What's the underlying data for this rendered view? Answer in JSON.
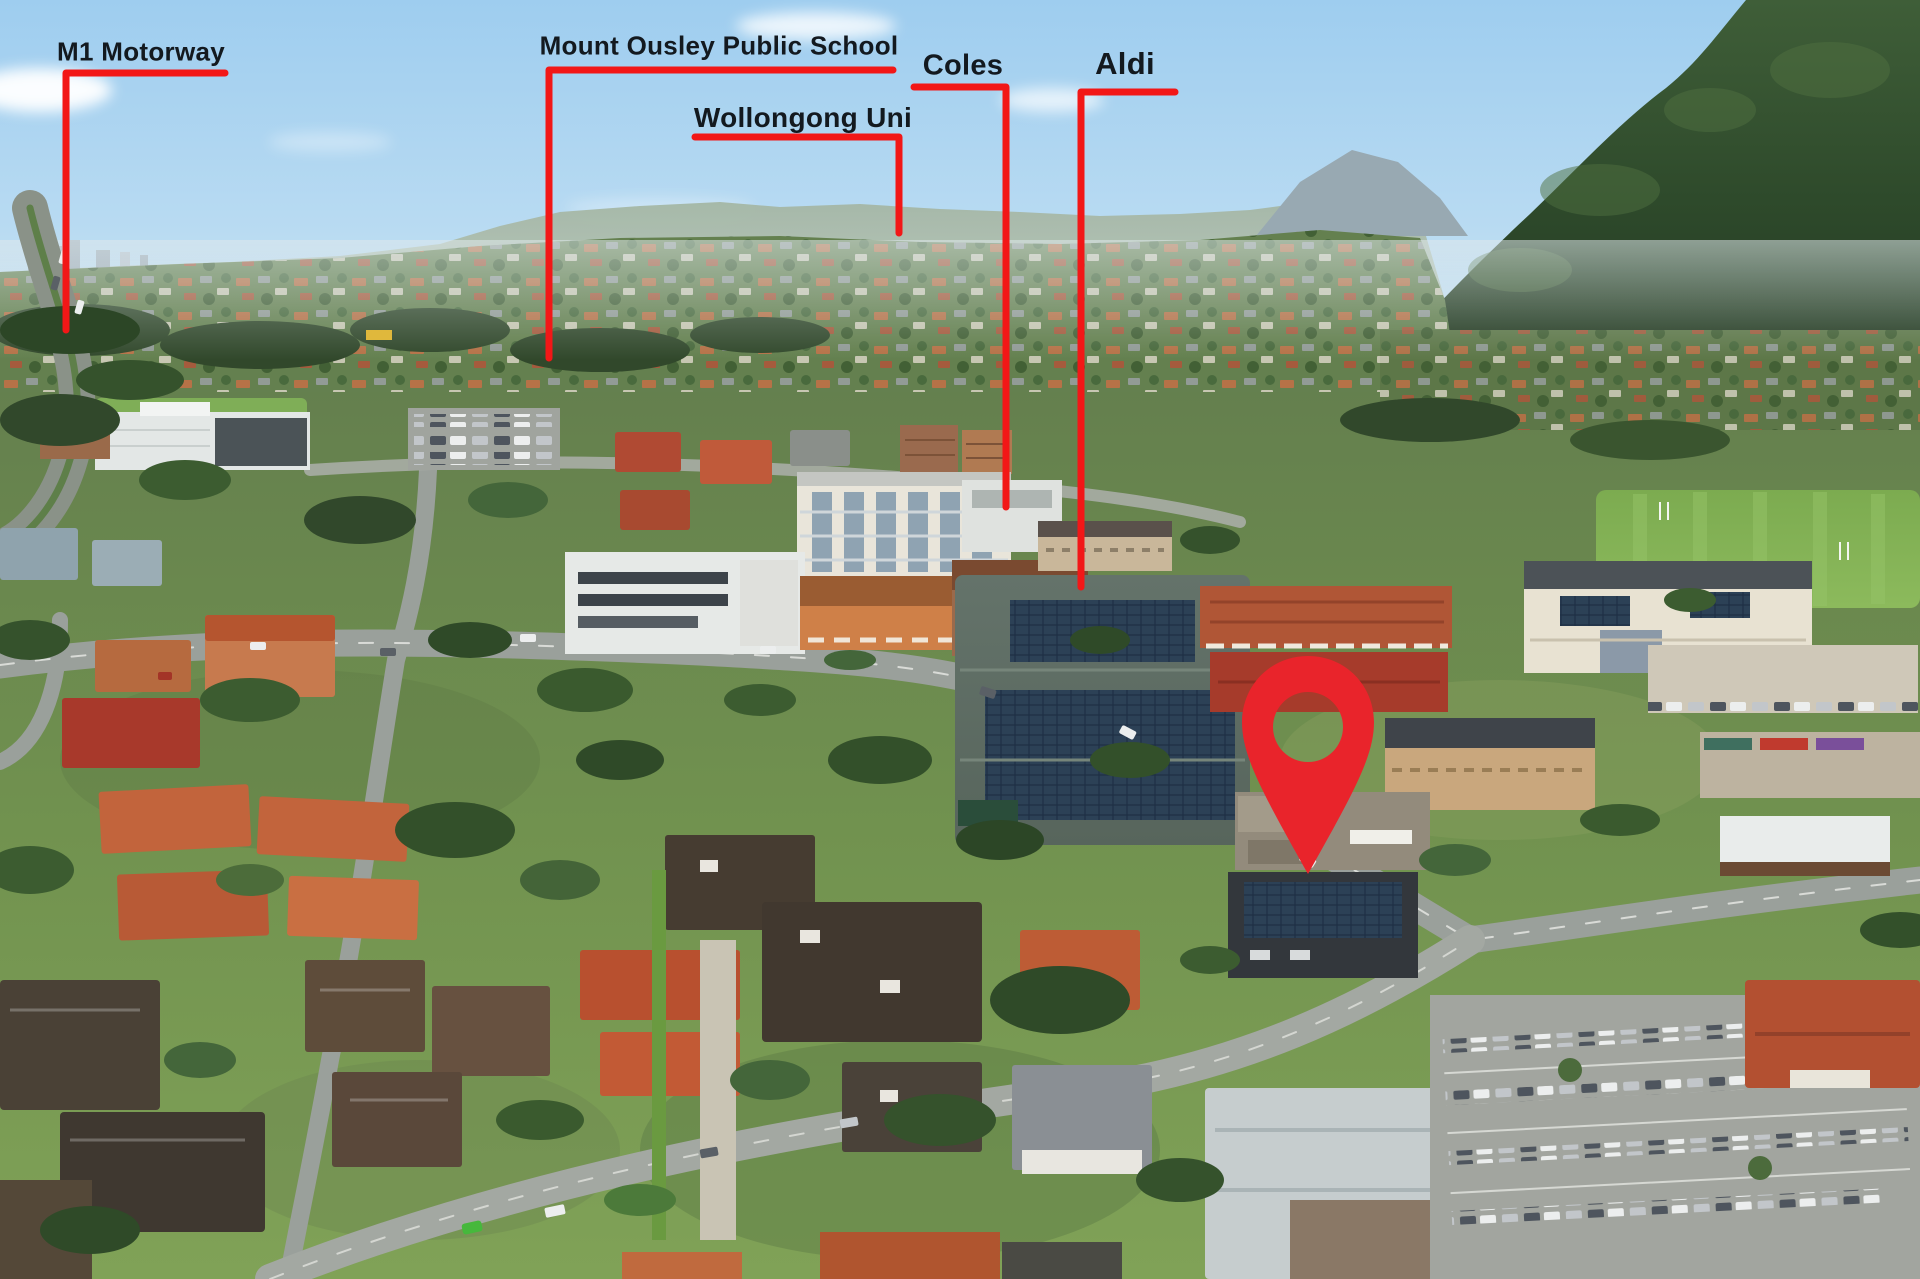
{
  "annotations": [
    {
      "id": "m1-motorway",
      "label": "M1 Motorway"
    },
    {
      "id": "mount-ousley-public-school",
      "label": "Mount Ousley Public School"
    },
    {
      "id": "wollongong-uni",
      "label": "Wollongong Uni"
    },
    {
      "id": "coles",
      "label": "Coles"
    },
    {
      "id": "aldi",
      "label": "Aldi"
    }
  ],
  "marker": {
    "icon": "location-pin-icon"
  },
  "colors": {
    "annotation_line": "#f21717",
    "marker_pin": "#e9242b",
    "label_text": "#13191f"
  }
}
